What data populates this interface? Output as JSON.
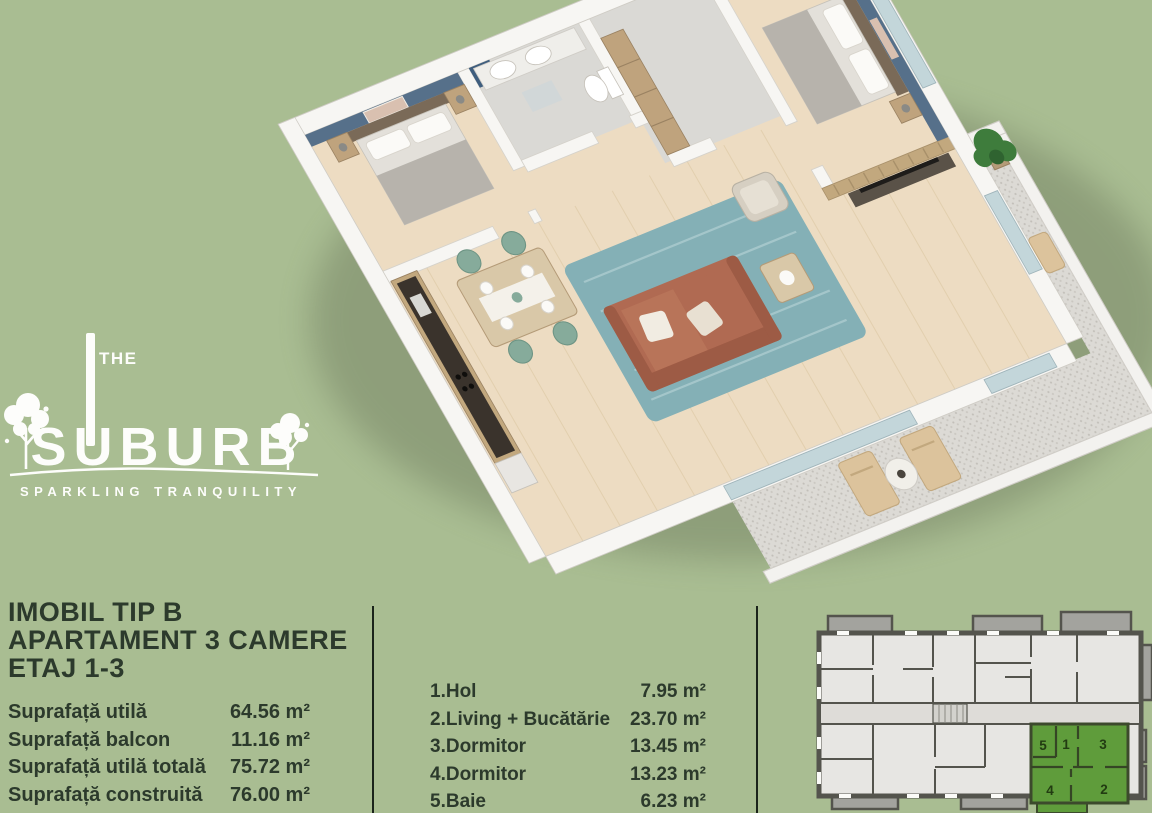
{
  "page": {
    "background": "#a9bd92"
  },
  "logo": {
    "the": "THE",
    "brand": "SUBURB",
    "tagline": "SPARKLING TRANQUILITY"
  },
  "info": {
    "title_line1": "IMOBIL TIP B",
    "title_line2": "APARTAMENT 3 CAMERE",
    "title_line3": "ETAJ 1-3",
    "areas": [
      {
        "label": "Suprafață utilă",
        "value": "64.56 m²"
      },
      {
        "label": "Suprafață balcon",
        "value": "11.16 m²"
      },
      {
        "label": "Suprafață utilă totală",
        "value": "75.72 m²"
      },
      {
        "label": "Suprafață construită",
        "value": "76.00 m²"
      }
    ]
  },
  "room_list": [
    {
      "label": "1.Hol",
      "value": "7.95 m²"
    },
    {
      "label": "2.Living + Bucătărie",
      "value": "23.70 m²"
    },
    {
      "label": "3.Dormitor",
      "value": "13.45 m²"
    },
    {
      "label": "4.Dormitor",
      "value": "13.23 m²"
    },
    {
      "label": "5.Baie",
      "value": "6.23 m²"
    }
  ],
  "building_diagram": {
    "highlighted_unit_rooms": [
      "5",
      "1",
      "3",
      "4",
      "2"
    ],
    "highlight_color": "#5f9c3b"
  },
  "colors": {
    "text_dark": "#2c3a2c",
    "divider": "#1b241b",
    "accent_wall_blue": "#56708a",
    "sofa_terracotta": "#b06a52"
  }
}
